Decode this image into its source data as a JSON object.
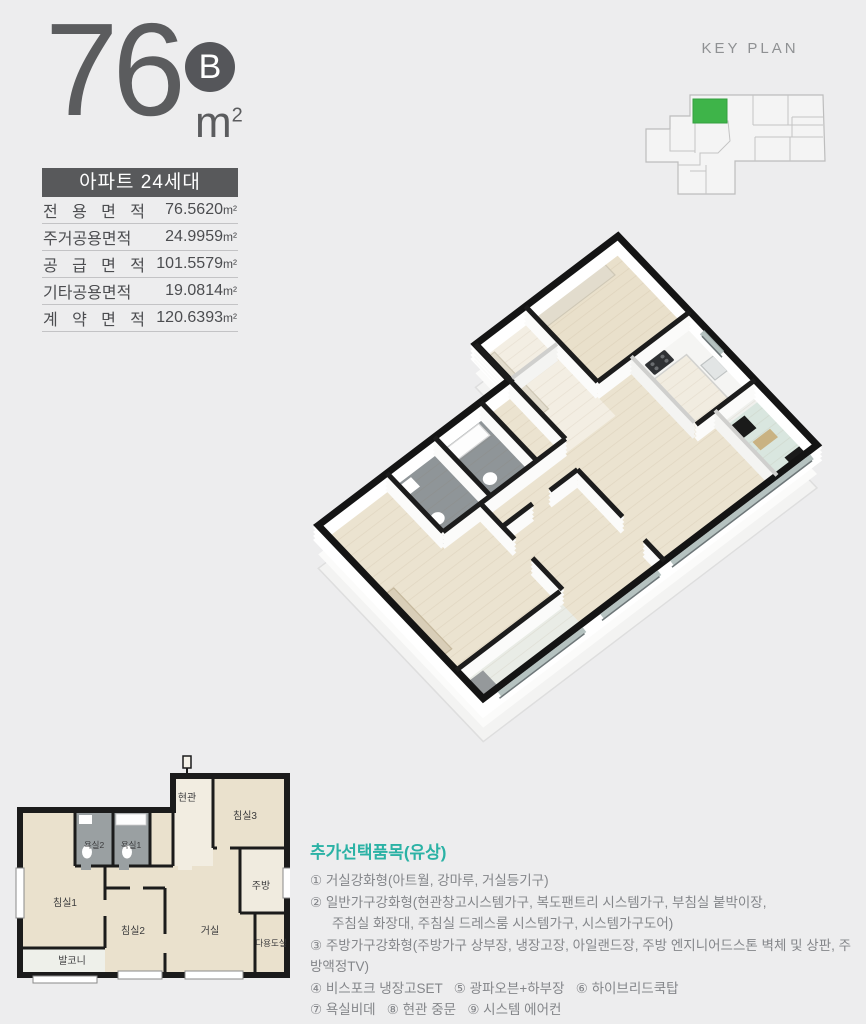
{
  "unit_header": {
    "area_number": "76",
    "type_badge": "B",
    "unit": "m",
    "unit_sup": "2"
  },
  "area_table": {
    "header": "아파트 24세대",
    "unit": "m²",
    "rows": [
      {
        "label": "전 용 면 적",
        "value": "76.5620"
      },
      {
        "label": "주거공용면적",
        "value": "24.9959"
      },
      {
        "label": "공 급 면 적",
        "value": "101.5579"
      },
      {
        "label": "기타공용면적",
        "value": "19.0814"
      },
      {
        "label": "계 약 면 적",
        "value": "120.6393"
      }
    ]
  },
  "keyplan": {
    "title": "KEY PLAN",
    "highlight_color": "#3eb449"
  },
  "floorplan_2d": {
    "rooms": [
      "현관",
      "침실3",
      "욕실2",
      "욕실1",
      "주방",
      "침실1",
      "침실2",
      "거실",
      "다용도실",
      "발코니"
    ]
  },
  "options": {
    "title": "추가선택품목(유상)",
    "lines": [
      "① 거실강화형(아트월, 강마루, 거실등기구)",
      "② 일반가구강화형(현관창고시스템가구, 복도팬트리 시스템가구, 부침실 붙박이장,",
      "주침실 화장대, 주침실 드레스룸 시스템가구, 시스템가구도어)",
      "③ 주방가구강화형(주방가구 상부장, 냉장고장, 아일랜드장, 주방 엔지니어드스톤 벽체 및 상판, 주방액정TV)",
      "④ 비스포크 냉장고SET   ⑤ 광파오븐+하부장   ⑥ 하이브리드쿡탑",
      "⑦ 욕실비데   ⑧ 현관 중문   ⑨ 시스템 에어컨"
    ]
  }
}
